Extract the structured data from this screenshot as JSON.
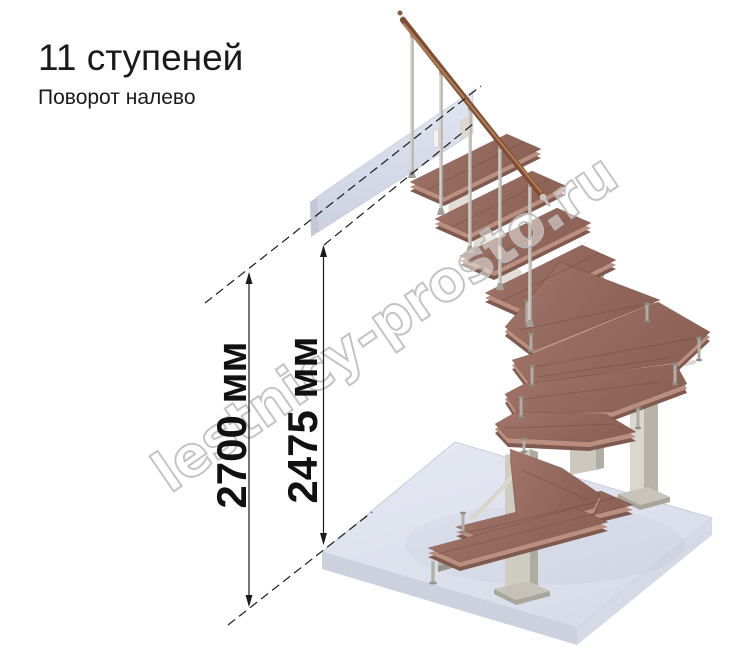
{
  "title": "11 ступеней",
  "subtitle": "Поворот налево",
  "stair": {
    "steps_count": 11,
    "turn_direction": "налево",
    "type": "модульная лестница с поворотом"
  },
  "dimensions": [
    {
      "label": "2700 мм",
      "value": 2700,
      "unit": "мм"
    },
    {
      "label": "2475 мм",
      "value": 2475,
      "unit": "мм"
    }
  ],
  "watermark": {
    "text": "lestnicy-prosto.ru"
  },
  "colors": {
    "background": "#ffffff",
    "wood_tread": "#9b6f63",
    "wood_edge": "#ba8f7f",
    "wood_shadow": "#7f5a50",
    "handrail": "#7c4c34",
    "metal_baluster": "#b5b2ac",
    "frame_cream": "#cfccc2",
    "floor_slab": "#dfe2ee",
    "landing_beam": "#d7dbe9",
    "dimension_ink": "#1c1c1c",
    "watermark_outline": "#bdbdbd"
  }
}
